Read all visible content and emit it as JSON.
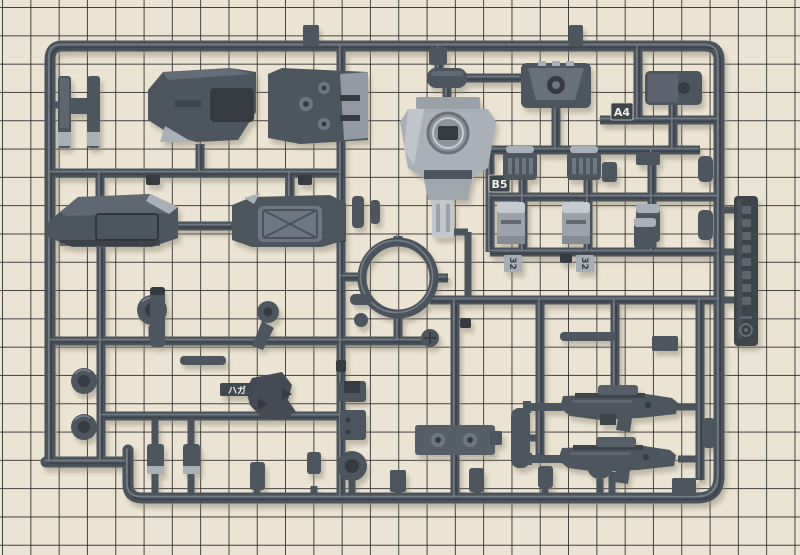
{
  "photo": {
    "alt": "Dark gray plastic model-kit parts runner (sprue) lying on a beige cutting mat with black grid squares"
  },
  "labels": {
    "position_a4": "A4",
    "position_b5": "B5",
    "gate_number_left": "32",
    "gate_number_right": "32",
    "runner_marking": "ハガ"
  },
  "colors": {
    "mat": "#ece4d2",
    "mat_grid": "#2b292c",
    "runner": "#4b535c",
    "runner_highlight": "#7b8590",
    "runner_shadow": "#2e343b",
    "part": "#4e565f",
    "part_dark": "#343a41",
    "part_light": "#6e7681",
    "silver": "#aab0b8",
    "silver_bright": "#c6cbd1",
    "tag": "#3d444c",
    "label_white": "#f0eee6",
    "digit_dark": "#383f47"
  }
}
